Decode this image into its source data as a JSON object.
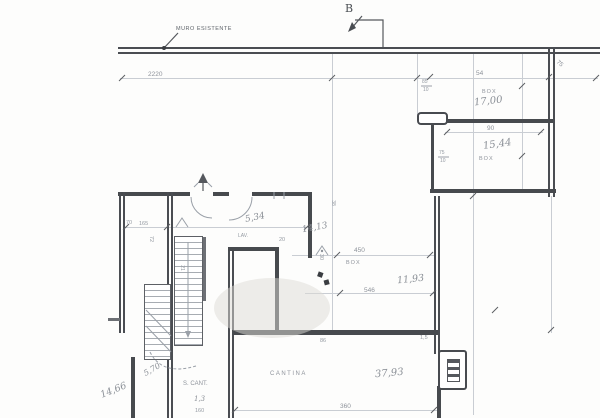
{
  "annotations": {
    "muro_esistente": "MURO ESISTENTE",
    "section_b": "B"
  },
  "rooms": {
    "box1": {
      "label": "BOX",
      "area": "17,00"
    },
    "box2": {
      "label": "BOX",
      "area": "15,44"
    },
    "box3": {
      "label": "BOX",
      "area": "11,93"
    },
    "cantina": {
      "label": "CANTINA",
      "area": "37,93"
    },
    "lav": {
      "label": "LAV.",
      "area": "5,34"
    },
    "room_center": {
      "area": "14,13"
    },
    "room_left": {
      "area": "14,66"
    },
    "stairs": {
      "label": "S. CANT.",
      "note": "5,70",
      "note2": "1,3"
    }
  },
  "dims": {
    "top": "2220",
    "box1_w": "54",
    "box1_frac_top": "85",
    "box1_frac_bot": "10",
    "box2_w": "90",
    "box2_frac_top": "75",
    "box2_frac_bot": "10",
    "right_side": "75",
    "box3_w1": "450",
    "box3_w2": "546",
    "box3_h": "30",
    "box3_t": "38",
    "cantina_w": "360",
    "cantina_n1": "86",
    "cantina_n2": "1,5",
    "left_a": "70",
    "left_b": "165",
    "left_c": "72",
    "center_a": "20",
    "stair_a": "21",
    "bottom_left": "160"
  }
}
